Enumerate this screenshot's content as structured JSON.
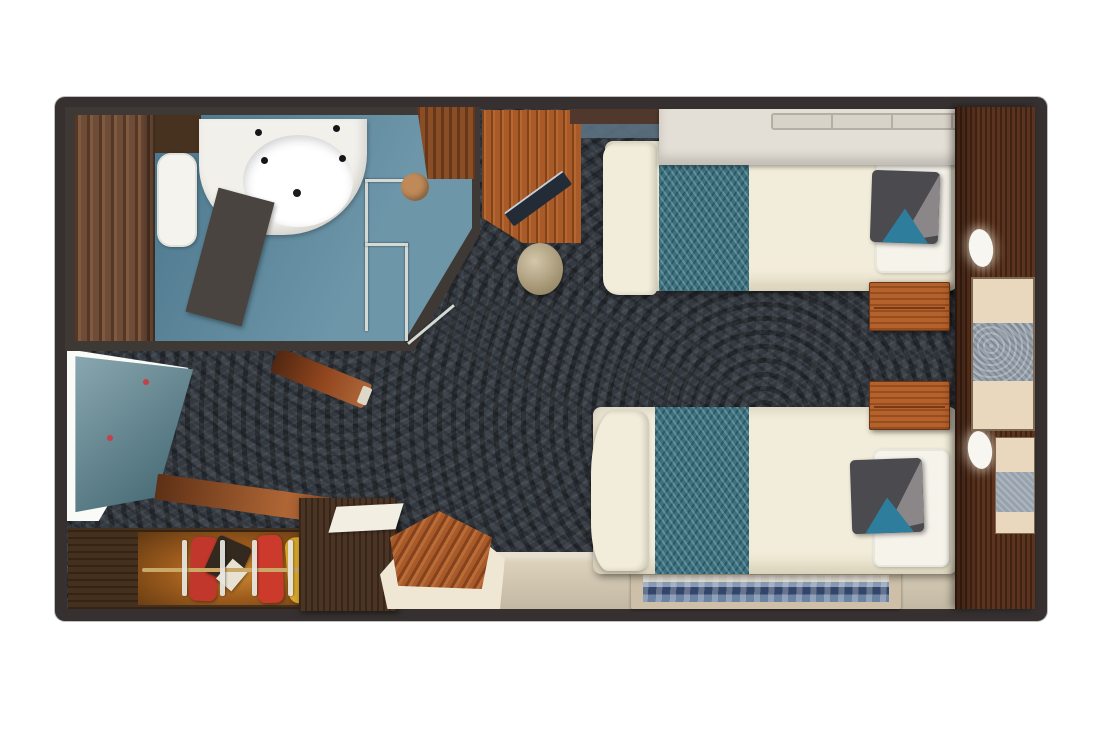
{
  "meta": {
    "description": "Top-down 3D rendered floor plan of a cruise ship stateroom with two twin beds, bathroom, desk, wardrobe and entrance",
    "furniture": [
      "bathroom",
      "wash-basin",
      "toilet",
      "shower-enclosure",
      "grab-rails",
      "desk",
      "laptop",
      "round-stool",
      "upper-berth-shelf",
      "twin-bed-1",
      "twin-bed-2",
      "teal-bed-runner",
      "accent-pillow",
      "nightstand-1",
      "nightstand-2",
      "headboard-wall",
      "reading-lamp-1",
      "reading-lamp-2",
      "vanity-ledge",
      "entrance-door",
      "wardrobe",
      "hanging-clothes",
      "sideboard",
      "luggage-bench",
      "area-rug",
      "carpet",
      "beige-floor"
    ]
  },
  "colors": {
    "page_bg": "#ffffff",
    "frame": "#363130",
    "wall": "#3f3936",
    "carpet": "#343a41",
    "bath_floor": "#528299",
    "bath_wood": "#6e4c38",
    "toilet_white": "#f5f3ee",
    "cabinet_dark": "#46321f",
    "counter_white": "#f2f0ea",
    "sink_white": "#ffffff",
    "drain_black": "#1c1c1c",
    "faucet_black": "#15151a",
    "partition_gray": "#49443f",
    "rail_metal": "#d4d9d4",
    "shower_tan": "#bf8a58",
    "bath_door_wood": "#8a4e26",
    "desk_wood": "#a85a28",
    "laptop_dark": "#232b37",
    "curtain_blue": "#5b7181",
    "stool_tan": "#bca97c",
    "wall_strip_brown": "#50382c",
    "shelf_white": "#e4dfd6",
    "shelf_rail": "#d8d3c9",
    "bed_cream": "#f2edda",
    "pillow_white": "#f6f3eb",
    "runner_teal": "#3c7280",
    "cushion_gray": "#4b4a4e",
    "cushion_gray_light": "#8b8789",
    "cushion_teal": "#2e7d9c",
    "nightstand_wood": "#b4612c",
    "wall_wood": "#5c331e",
    "lamp_white": "#f8f6f0",
    "vanity_beige": "#e9d8be",
    "vanity_runner": "#98a2ad",
    "floor_beige": "#dcd1ba",
    "rug_border": "#cec0a8",
    "entry_light": "#fafaf6",
    "door_teal": "#5f8894",
    "door_dot_red": "#c4404a",
    "closet_wood": "#45301e",
    "closet_glow": "#95571c",
    "closet_rail": "#caa868",
    "clothes_red": "#c2372b",
    "clothes_red2": "#cc3a2c",
    "clothes_yellow": "#d7a72e",
    "clothes_dark": "#33291f",
    "garment_white": "#e8e2d2",
    "hanger_white": "#e9e7e2",
    "sideboard_wood": "#4b3424",
    "paper_white": "#f2eee2",
    "bench_wood": "#a85a2a",
    "bench_base": "#efe7d3",
    "bench_diag_wood": "#93471f",
    "counter_diag_wood": "#9c5024",
    "bench_tip": "#ded8c8"
  }
}
